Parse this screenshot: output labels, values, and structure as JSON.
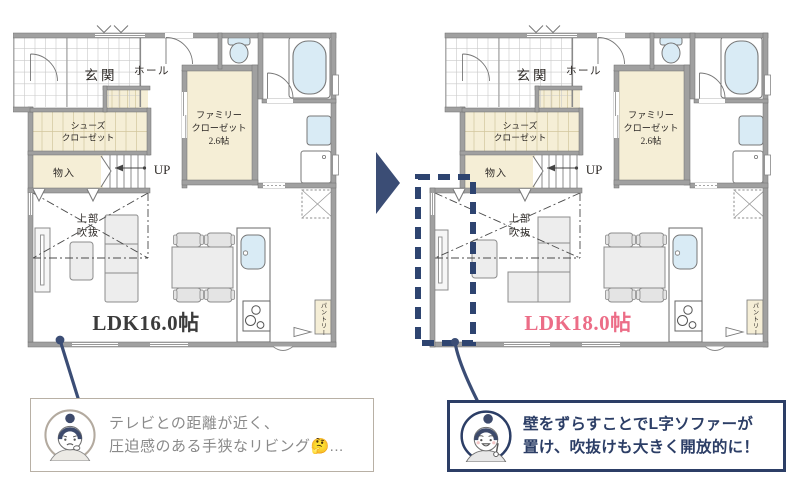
{
  "palette": {
    "navy": "#2c3e66",
    "navy_dash": "#2e4470",
    "arrow": "#3b4d75",
    "pink": "#ec6d87",
    "ink": "#2f2b28",
    "wall": "#a0a0a0",
    "wall_edge": "#6e6e6e",
    "cream": "#f5eed6",
    "shelf": "#d2c69c",
    "grid": "#c9c9c9",
    "fixture_blue": "#d9ebf5",
    "furn": "#ededed",
    "furn_line": "#8c8c8c",
    "line": "#777777",
    "gray_text": "#8a8a8a",
    "tan_border": "#b8b0a5"
  },
  "icons": {
    "transform_arrow": "right-solid-triangle",
    "before_avatar": "woman-worried-face",
    "after_avatar": "woman-smiling-pointing"
  },
  "plans": {
    "shared_labels": {
      "entrance": "玄関",
      "hall": "ホール",
      "shoe_closet_line1": "シューズ",
      "shoe_closet_line2": "クローゼット",
      "storage": "物入",
      "up": "UP",
      "family_closet_line1": "ファミリー",
      "family_closet_line2": "クローゼット",
      "family_closet_line3": "2.6帖",
      "void_line1": "上部",
      "void_line2": "吹抜",
      "pantry": "パントリー"
    },
    "before": {
      "ldk_label": "LDK16.0帖",
      "ldk_color": "#3b3b3b"
    },
    "after": {
      "ldk_label": "LDK18.0帖",
      "ldk_color": "#ec6d87"
    }
  },
  "callouts": {
    "before": {
      "line1": "テレビとの距離が近く、",
      "line2": "圧迫感のある手狭なリビング🤔..."
    },
    "after": {
      "line1": "壁をずらすことでL字ソファーが",
      "line2": "置け、吹抜けも大きく開放的に！"
    }
  }
}
